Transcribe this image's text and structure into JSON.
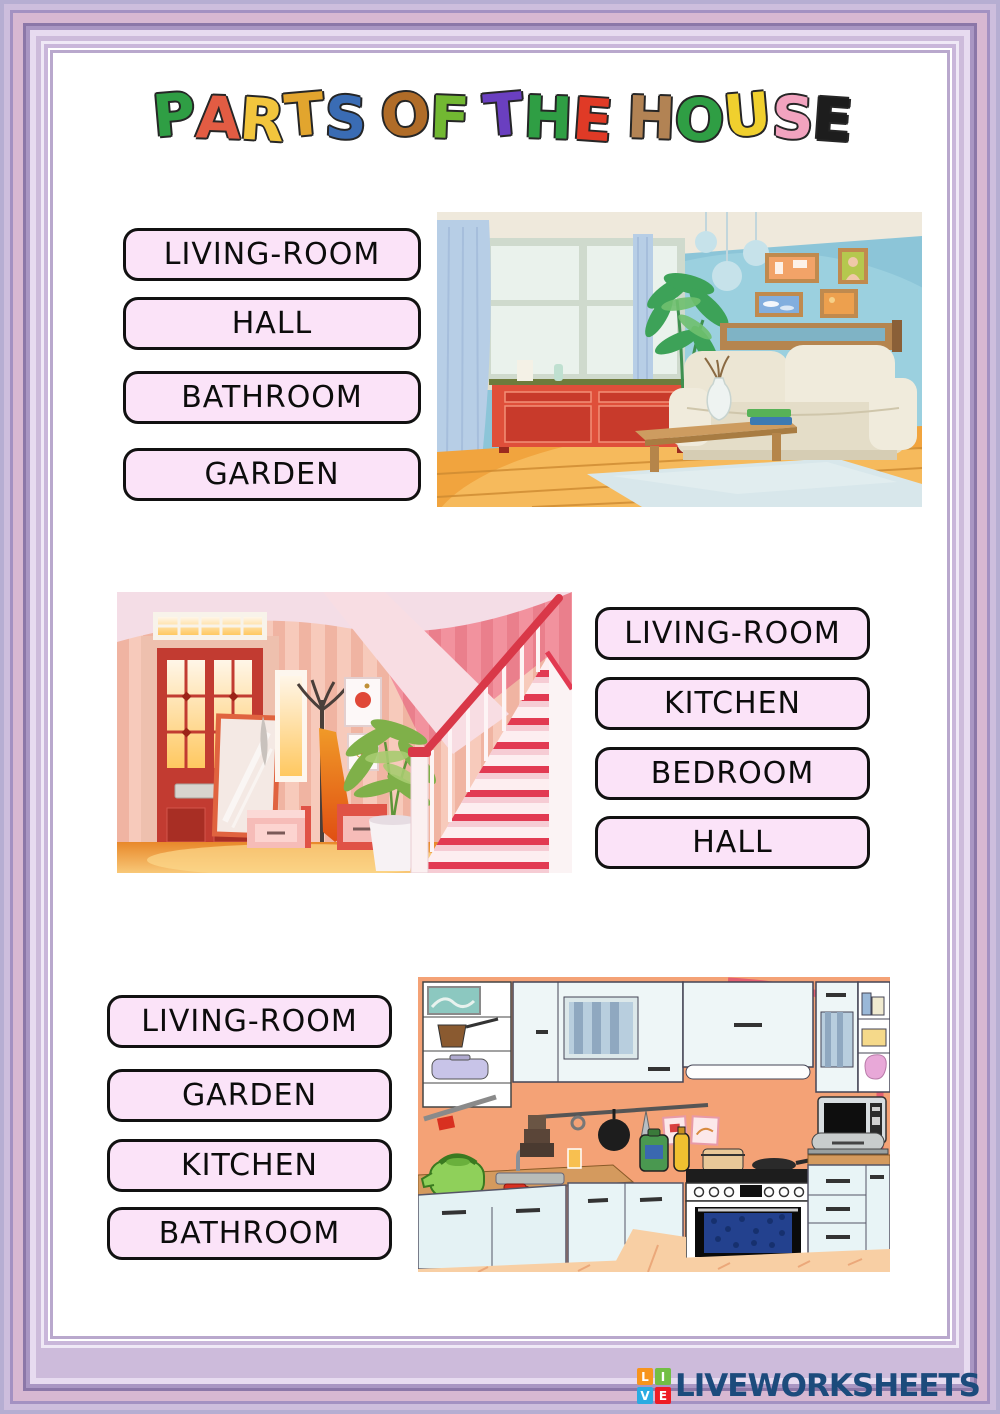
{
  "title": {
    "text": "PARTS OF THE HOUSE",
    "letters": [
      {
        "ch": "P",
        "color": "#2f9e44"
      },
      {
        "ch": "A",
        "color": "#e25c43"
      },
      {
        "ch": "R",
        "color": "#f2c53d"
      },
      {
        "ch": "T",
        "color": "#e2a52e"
      },
      {
        "ch": "S",
        "color": "#3a6cb4"
      },
      {
        "ch": " "
      },
      {
        "ch": "O",
        "color": "#b06c28"
      },
      {
        "ch": "F",
        "color": "#72b832"
      },
      {
        "ch": " "
      },
      {
        "ch": "T",
        "color": "#6a3fc0"
      },
      {
        "ch": "H",
        "color": "#2f9e44"
      },
      {
        "ch": "E",
        "color": "#e03a26"
      },
      {
        "ch": " "
      },
      {
        "ch": "H",
        "color": "#b28354"
      },
      {
        "ch": "O",
        "color": "#2f9e44"
      },
      {
        "ch": "U",
        "color": "#f0d02e"
      },
      {
        "ch": "S",
        "color": "#f2a3bf"
      },
      {
        "ch": "E",
        "color": "#1d1d1d"
      }
    ]
  },
  "exercises": [
    {
      "id": "living-room",
      "picture": "living room illustration",
      "options": [
        "LIVING-ROOM",
        "HALL",
        "BATHROOM",
        "GARDEN"
      ]
    },
    {
      "id": "hall",
      "picture": "hall with staircase illustration",
      "options": [
        "LIVING-ROOM",
        "KITCHEN",
        "BEDROOM",
        "HALL"
      ]
    },
    {
      "id": "kitchen",
      "picture": "kitchen illustration",
      "options": [
        "LIVING-ROOM",
        "GARDEN",
        "KITCHEN",
        "BATHROOM"
      ]
    }
  ],
  "footer": {
    "brand": "LIVEWORKSHEETS",
    "brand_color": "#1c4b7c",
    "logo_tiles": [
      {
        "ch": "L",
        "bg": "#f7941d"
      },
      {
        "ch": "I",
        "bg": "#72bf44"
      },
      {
        "ch": "V",
        "bg": "#2aabe2"
      },
      {
        "ch": "E",
        "bg": "#ee1c25"
      }
    ]
  },
  "styles": {
    "option_fill": "#fbe3f8",
    "option_border": "#111111",
    "frame_pink": "#d7b8d2",
    "frame_lilac": "#cdbbdb"
  }
}
